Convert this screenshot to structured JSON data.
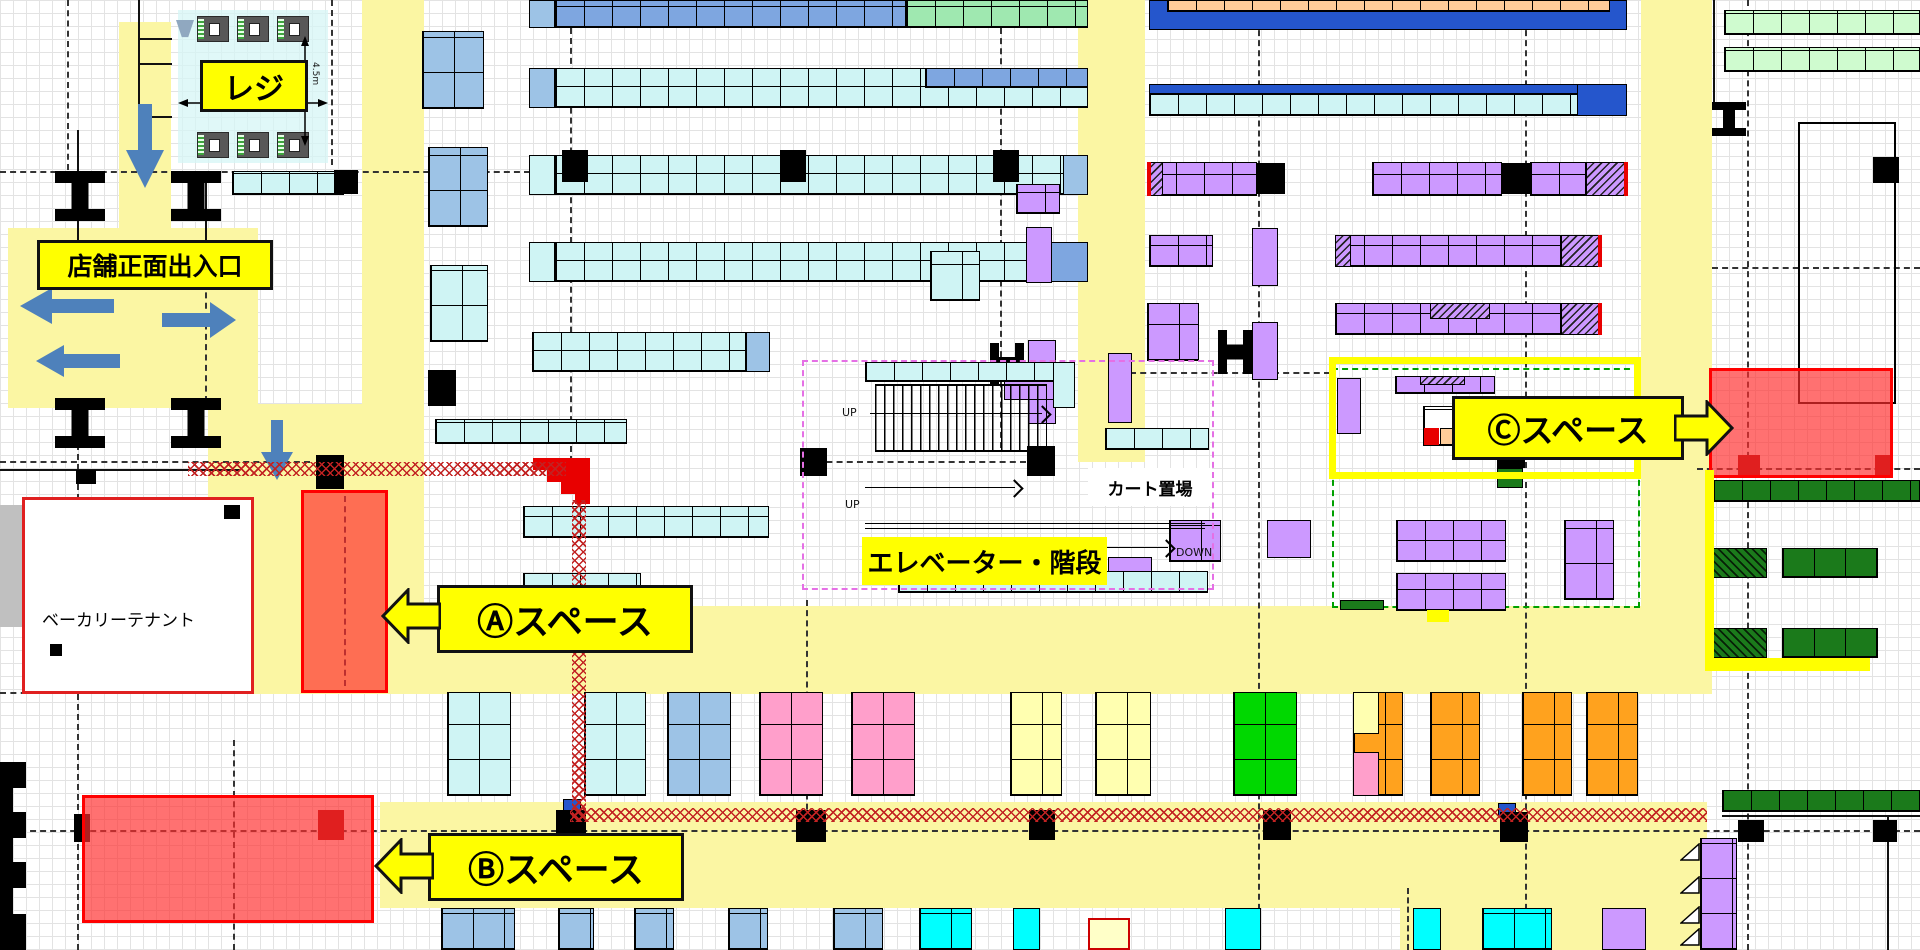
{
  "title": "店舗フロアマップ",
  "labels": {
    "register": "レジ",
    "entrance": "店舗正面出入口",
    "space_a": "Ⓐスペース",
    "space_b": "Ⓑスペース",
    "space_c": "Ⓒスペース",
    "elevator": "エレベーター・階段",
    "cart_area": "カート置場",
    "bakery": "ベーカリーテナント",
    "up": "UP",
    "down": "DOWN",
    "dim": "4.5m"
  },
  "palette": {
    "aisle_yellow": "#FBF6A3",
    "label_yellow": "#FFFF00",
    "shelf_cyan": "#CFF4F4",
    "shelf_blue_light": "#9DC3E6",
    "shelf_blue": "#7EA6E0",
    "shelf_blue_deep": "#2556CC",
    "shelf_green": "#9FE8B0",
    "shelf_mint": "#CFFBCF",
    "shelf_peach": "#FFCC99",
    "shelf_purple": "#CC99FF",
    "shelf_pink": "#FF9FCB",
    "shelf_orange": "#FFA21E",
    "shelf_pale_yellow": "#FFFFB0",
    "shelf_bright_green": "#00D800",
    "shelf_bright_cyan": "#00FFFF",
    "shelf_dark_green": "#1B7A1B",
    "zone_red": "#FF2D2D",
    "pillar_black": "#000000",
    "pillar_dark_red": "#A00000",
    "arrow_blue": "#4E81BB",
    "crosshatch_red": "#C22222"
  },
  "aisles": [
    [
      119,
      22,
      52,
      382
    ],
    [
      8,
      228,
      250,
      180
    ],
    [
      208,
      404,
      216,
      290
    ],
    [
      362,
      0,
      62,
      694
    ],
    [
      284,
      606,
      1423,
      88
    ],
    [
      380,
      802,
      1327,
      106
    ],
    [
      1400,
      840,
      307,
      110
    ],
    [
      1641,
      0,
      71,
      694
    ],
    [
      1078,
      0,
      67,
      462
    ]
  ],
  "dashes_h": [
    [
      0,
      171,
      530
    ],
    [
      0,
      461,
      310
    ],
    [
      806,
      461,
      220
    ],
    [
      1697,
      468,
      223
    ],
    [
      0,
      830,
      1920
    ],
    [
      0,
      692,
      120
    ],
    [
      1712,
      267,
      208
    ],
    [
      1130,
      372,
      200,
      "pinkd"
    ]
  ],
  "dashes_v": [
    [
      67,
      0,
      170
    ],
    [
      77,
      404,
      546
    ],
    [
      570,
      28,
      434
    ],
    [
      806,
      600,
      230
    ],
    [
      1000,
      28,
      420
    ],
    [
      1258,
      0,
      950
    ],
    [
      1525,
      0,
      950
    ],
    [
      1747,
      0,
      950
    ],
    [
      205,
      282,
      120
    ],
    [
      233,
      740,
      210
    ],
    [
      331,
      0,
      165
    ],
    [
      344,
      496,
      190,
      "ddr"
    ],
    [
      1407,
      888,
      62
    ]
  ],
  "registers": [
    [
      197,
      16
    ],
    [
      237,
      16
    ],
    [
      277,
      16
    ],
    [
      197,
      132
    ],
    [
      237,
      132
    ],
    [
      277,
      132
    ]
  ],
  "blocks": [
    [
      178,
      10,
      150,
      153,
      "rej"
    ],
    [
      77,
      130,
      2,
      116,
      "ln"
    ],
    [
      205,
      177,
      2,
      70,
      "ln"
    ],
    [
      138,
      0,
      2,
      118,
      "ln"
    ],
    [
      138,
      38,
      34,
      2,
      "ln"
    ],
    [
      138,
      63,
      34,
      2,
      "ln"
    ],
    [
      138,
      116,
      34,
      2,
      "ln"
    ],
    [
      0,
      469,
      240,
      2,
      "ln"
    ],
    [
      1722,
      815,
      198,
      2,
      "ln"
    ],
    [
      1713,
      0,
      2,
      102,
      "ln"
    ],
    [
      1887,
      817,
      2,
      133,
      "ln"
    ],
    [
      232,
      171,
      112,
      24,
      "cy cells"
    ],
    [
      334,
      170,
      24,
      24,
      "pil"
    ],
    [
      529,
      0,
      26,
      28,
      "lb"
    ],
    [
      555,
      0,
      351,
      28,
      "mb cells"
    ],
    [
      906,
      0,
      182,
      28,
      "gn cells"
    ],
    [
      529,
      68,
      26,
      40,
      "lb"
    ],
    [
      555,
      68,
      533,
      40,
      "cy cells"
    ],
    [
      925,
      68,
      163,
      20,
      "mb cells"
    ],
    [
      529,
      155,
      26,
      40,
      "cy"
    ],
    [
      555,
      155,
      533,
      40,
      "cy cells"
    ],
    [
      1063,
      155,
      25,
      40,
      "lb"
    ],
    [
      562,
      150,
      26,
      32,
      "pil"
    ],
    [
      780,
      150,
      26,
      32,
      "pil"
    ],
    [
      993,
      150,
      26,
      32,
      "pil"
    ],
    [
      529,
      242,
      26,
      40,
      "cy"
    ],
    [
      555,
      242,
      533,
      40,
      "cy cells"
    ],
    [
      1040,
      242,
      48,
      40,
      "mb"
    ],
    [
      532,
      332,
      214,
      40,
      "cy cells"
    ],
    [
      746,
      332,
      24,
      40,
      "lb"
    ],
    [
      435,
      419,
      192,
      25,
      "cy cells"
    ],
    [
      523,
      506,
      246,
      32,
      "cy cells"
    ],
    [
      523,
      573,
      118,
      40,
      "cy cells"
    ],
    [
      422,
      31,
      62,
      78,
      "lb cellsb"
    ],
    [
      428,
      147,
      60,
      80,
      "lb cellsb"
    ],
    [
      430,
      265,
      58,
      77,
      "cy cellsb"
    ],
    [
      428,
      370,
      28,
      36,
      "pil"
    ],
    [
      1149,
      0,
      478,
      30,
      "db"
    ],
    [
      1167,
      0,
      443,
      12,
      "pe cells"
    ],
    [
      1149,
      84,
      478,
      32,
      "cy cells"
    ],
    [
      1149,
      84,
      478,
      10,
      "db"
    ],
    [
      1577,
      84,
      50,
      32,
      "db"
    ],
    [
      1147,
      162,
      110,
      34,
      "pu cells"
    ],
    [
      1147,
      162,
      16,
      34,
      "hp"
    ],
    [
      1147,
      162,
      4,
      34,
      "rl"
    ],
    [
      1257,
      163,
      28,
      31,
      "pil"
    ],
    [
      1372,
      162,
      130,
      34,
      "pu cells"
    ],
    [
      1502,
      163,
      28,
      31,
      "pil"
    ],
    [
      1530,
      162,
      56,
      34,
      "pu cells"
    ],
    [
      1586,
      162,
      42,
      34,
      "hp"
    ],
    [
      1624,
      162,
      4,
      34,
      "rl"
    ],
    [
      1149,
      235,
      64,
      32,
      "pu cells"
    ],
    [
      1252,
      228,
      26,
      58,
      "pu"
    ],
    [
      1335,
      235,
      226,
      32,
      "pu cells"
    ],
    [
      1335,
      235,
      16,
      32,
      "hp"
    ],
    [
      1561,
      235,
      40,
      32,
      "hp"
    ],
    [
      1598,
      235,
      4,
      32,
      "rl"
    ],
    [
      1147,
      303,
      52,
      58,
      "pu cellsb"
    ],
    [
      1252,
      322,
      26,
      58,
      "pu"
    ],
    [
      1218,
      330,
      34,
      44,
      "pilH"
    ],
    [
      1335,
      303,
      226,
      32,
      "pu cells"
    ],
    [
      1430,
      303,
      60,
      16,
      "hp"
    ],
    [
      1561,
      303,
      40,
      32,
      "hp"
    ],
    [
      1598,
      303,
      4,
      32,
      "rl"
    ],
    [
      1332,
      368,
      308,
      240,
      "gd"
    ],
    [
      1337,
      378,
      24,
      56,
      "pu"
    ],
    [
      1395,
      376,
      100,
      18,
      "pu cells"
    ],
    [
      1420,
      376,
      45,
      9,
      "hp"
    ],
    [
      1423,
      406,
      62,
      40,
      "wh cellsb"
    ],
    [
      1424,
      428,
      15,
      17,
      "rl"
    ],
    [
      1440,
      428,
      20,
      17,
      "pe"
    ],
    [
      1497,
      458,
      28,
      10,
      "pil"
    ],
    [
      1497,
      468,
      26,
      20,
      "dg"
    ],
    [
      1108,
      353,
      24,
      70,
      "pu"
    ],
    [
      1169,
      520,
      52,
      42,
      "pu cellsb"
    ],
    [
      1108,
      557,
      44,
      30,
      "pu"
    ],
    [
      1267,
      520,
      44,
      38,
      "pu"
    ],
    [
      1396,
      520,
      110,
      42,
      "pu cells"
    ],
    [
      1396,
      573,
      110,
      38,
      "pu cells"
    ],
    [
      1564,
      520,
      50,
      80,
      "pu cellsb"
    ],
    [
      1427,
      610,
      22,
      12,
      "yl"
    ],
    [
      1340,
      600,
      44,
      10,
      "dg"
    ],
    [
      1016,
      184,
      44,
      30,
      "pu cells"
    ],
    [
      1026,
      227,
      26,
      56,
      "pu"
    ],
    [
      930,
      251,
      50,
      50,
      "cy cellsb"
    ],
    [
      990,
      343,
      34,
      42,
      "pilH"
    ],
    [
      1028,
      340,
      28,
      84,
      "pu"
    ],
    [
      1004,
      366,
      62,
      34,
      "pu"
    ],
    [
      1105,
      428,
      104,
      22,
      "cy cells"
    ],
    [
      865,
      362,
      210,
      20,
      "cy cells"
    ],
    [
      1053,
      362,
      22,
      46,
      "cy"
    ],
    [
      1027,
      446,
      28,
      30,
      "pil"
    ],
    [
      800,
      448,
      27,
      28,
      "pil"
    ],
    [
      898,
      571,
      310,
      22,
      "cy cells"
    ],
    [
      802,
      360,
      412,
      230,
      "md"
    ],
    [
      1724,
      10,
      196,
      25,
      "mint cells"
    ],
    [
      1724,
      47,
      196,
      25,
      "mint cells"
    ],
    [
      1873,
      157,
      26,
      26,
      "pil"
    ],
    [
      1798,
      122,
      98,
      282,
      "ob"
    ],
    [
      1713,
      480,
      207,
      22,
      "dg cells"
    ],
    [
      1713,
      548,
      54,
      30,
      "hg"
    ],
    [
      1782,
      548,
      96,
      30,
      "dg cellsb"
    ],
    [
      1713,
      628,
      54,
      30,
      "hg"
    ],
    [
      1782,
      628,
      96,
      30,
      "dg cellsb"
    ],
    [
      1722,
      790,
      198,
      22,
      "dg cells"
    ],
    [
      1738,
      820,
      26,
      22,
      "pil"
    ],
    [
      1873,
      820,
      24,
      22,
      "pil"
    ],
    [
      1700,
      838,
      37,
      112,
      "pu cellsb"
    ],
    [
      447,
      692,
      64,
      104,
      "cy cellsb"
    ],
    [
      584,
      692,
      62,
      104,
      "cy cellsb"
    ],
    [
      667,
      692,
      64,
      104,
      "lb cellsb"
    ],
    [
      759,
      692,
      64,
      104,
      "pk cellsb"
    ],
    [
      851,
      692,
      64,
      104,
      "pk cellsb"
    ],
    [
      1010,
      692,
      52,
      104,
      "py cellsb"
    ],
    [
      1095,
      692,
      56,
      104,
      "py cellsb"
    ],
    [
      1233,
      692,
      64,
      104,
      "bg2 cellsb"
    ],
    [
      1353,
      692,
      50,
      104,
      "og cellsb"
    ],
    [
      1353,
      692,
      26,
      42,
      "pyc"
    ],
    [
      1353,
      752,
      26,
      44,
      "pkc"
    ],
    [
      1430,
      692,
      50,
      104,
      "og cellsb"
    ],
    [
      1522,
      692,
      50,
      104,
      "og cellsb"
    ],
    [
      1586,
      692,
      52,
      104,
      "og cellsb"
    ],
    [
      563,
      799,
      18,
      12,
      "db"
    ],
    [
      556,
      810,
      30,
      32,
      "pil"
    ],
    [
      796,
      810,
      30,
      32,
      "pil"
    ],
    [
      1029,
      810,
      26,
      30,
      "pil"
    ],
    [
      1263,
      810,
      28,
      30,
      "pil"
    ],
    [
      1498,
      803,
      18,
      14,
      "db"
    ],
    [
      1500,
      812,
      28,
      30,
      "pil"
    ],
    [
      441,
      908,
      74,
      42,
      "lb cellsb"
    ],
    [
      558,
      908,
      36,
      42,
      "lb cellsb"
    ],
    [
      634,
      908,
      40,
      42,
      "lb cellsb"
    ],
    [
      728,
      908,
      40,
      42,
      "lb cellsb"
    ],
    [
      833,
      908,
      50,
      42,
      "lb cellsb"
    ],
    [
      919,
      908,
      53,
      42,
      "bc cellsb"
    ],
    [
      1013,
      908,
      27,
      42,
      "bc"
    ],
    [
      1088,
      918,
      42,
      32,
      "pyr"
    ],
    [
      1225,
      908,
      36,
      42,
      "bc"
    ],
    [
      1413,
      908,
      28,
      42,
      "bc"
    ],
    [
      1482,
      908,
      70,
      42,
      "bc cellsb"
    ],
    [
      1602,
      908,
      44,
      42,
      "pu"
    ],
    [
      0,
      505,
      22,
      122,
      "gray"
    ],
    [
      22,
      497,
      232,
      197,
      "bak"
    ],
    [
      224,
      505,
      16,
      14,
      "pil"
    ],
    [
      50,
      644,
      12,
      12,
      "pil"
    ],
    [
      76,
      470,
      20,
      14,
      "pil"
    ],
    [
      55,
      171,
      50,
      50,
      "pilI"
    ],
    [
      171,
      171,
      50,
      50,
      "pilI"
    ],
    [
      55,
      398,
      50,
      50,
      "pilI"
    ],
    [
      171,
      398,
      50,
      50,
      "pilI"
    ],
    [
      1712,
      102,
      34,
      34,
      "pilI"
    ],
    [
      316,
      455,
      28,
      34,
      "pil"
    ],
    [
      188,
      462,
      378,
      14,
      "xh"
    ],
    [
      572,
      500,
      14,
      322,
      "xh"
    ],
    [
      570,
      808,
      1137,
      14,
      "xh"
    ],
    [
      533,
      458,
      57,
      12,
      "rf"
    ],
    [
      547,
      470,
      43,
      12,
      "rf"
    ],
    [
      561,
      482,
      29,
      12,
      "rf"
    ],
    [
      575,
      494,
      15,
      10,
      "rf"
    ],
    [
      301,
      490,
      87,
      203,
      "rz"
    ],
    [
      82,
      795,
      292,
      128,
      "rz"
    ],
    [
      74,
      814,
      16,
      28,
      "pil"
    ],
    [
      318,
      810,
      26,
      30,
      "drp"
    ],
    [
      0,
      762,
      26,
      26,
      "pil"
    ],
    [
      0,
      788,
      13,
      24,
      "pil"
    ],
    [
      0,
      812,
      26,
      26,
      "pil"
    ],
    [
      0,
      838,
      13,
      24,
      "pil"
    ],
    [
      0,
      862,
      26,
      26,
      "pil"
    ],
    [
      0,
      888,
      13,
      26,
      "pil"
    ],
    [
      0,
      914,
      26,
      36,
      "pil"
    ],
    [
      1709,
      368,
      184,
      110,
      "rz"
    ],
    [
      1738,
      455,
      22,
      22,
      "drp"
    ],
    [
      1875,
      455,
      18,
      20,
      "drp"
    ],
    [
      1705,
      470,
      9,
      200,
      "yl"
    ],
    [
      1705,
      658,
      165,
      13,
      "yl"
    ],
    [
      1329,
      357,
      312,
      122,
      "yb"
    ]
  ]
}
